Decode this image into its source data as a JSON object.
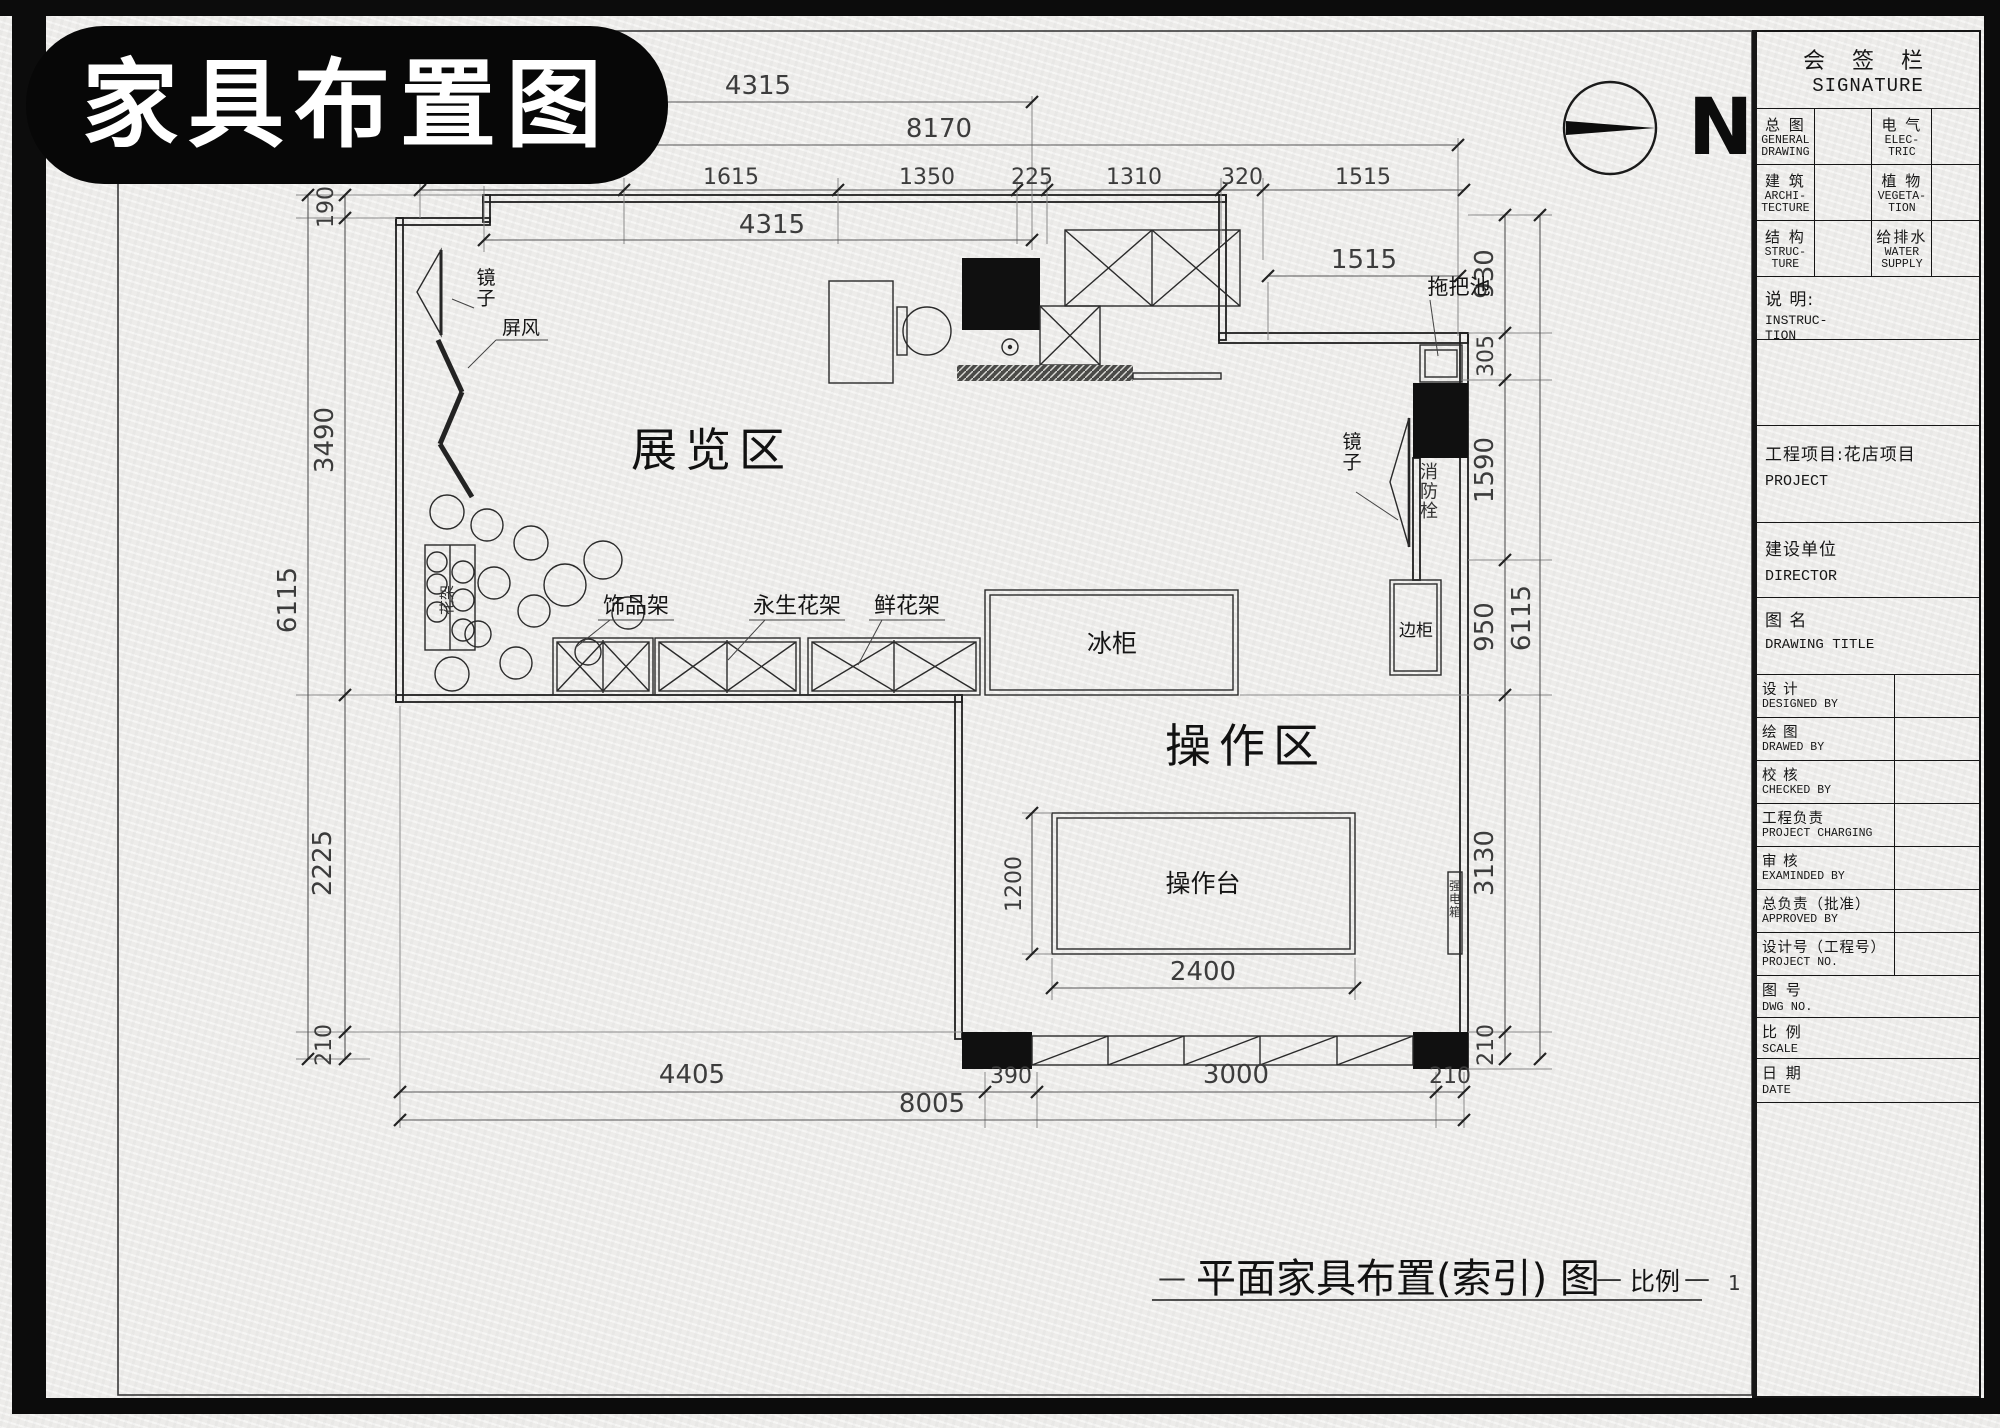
{
  "badge": {
    "title": "家具布置图"
  },
  "compass": {
    "label": "N"
  },
  "signature": {
    "title_cn": "会 签 栏",
    "title_en": "SIGNATURE",
    "cells": [
      {
        "cn": "总 图",
        "en": "GENERAL\nDRAWING"
      },
      {
        "cn": "电 气",
        "en": "ELEC-\nTRIC"
      },
      {
        "cn": "建 筑",
        "en": "ARCHI-\nTECTURE"
      },
      {
        "cn": "植 物",
        "en": "VEGETA-\nTION"
      },
      {
        "cn": "结 构",
        "en": "STRUC-\nTURE"
      },
      {
        "cn": "给排水",
        "en": "WATER\nSUPPLY"
      }
    ]
  },
  "titleblock": {
    "instruction": {
      "cn": "说  明:",
      "en": "INSTRUC-\n TION"
    },
    "project": {
      "cn": "工程项目:花店项目",
      "en": "PROJECT"
    },
    "director": {
      "cn": "建设单位",
      "en": "DIRECTOR"
    },
    "drawing_title": {
      "cn": "图  名",
      "en": "DRAWING TITLE"
    },
    "rows": [
      {
        "cn": "设  计",
        "en": "DESIGNED  BY"
      },
      {
        "cn": "绘  图",
        "en": "DRAWED  BY"
      },
      {
        "cn": "校  核",
        "en": "CHECKED  BY"
      },
      {
        "cn": "工程负责",
        "en": "PROJECT CHARGING"
      },
      {
        "cn": "审  核",
        "en": "EXAMINDED  BY"
      },
      {
        "cn": "总负责（批准）",
        "en": "APPROVED  BY"
      },
      {
        "cn": "设计号（工程号）",
        "en": "PROJECT NO."
      }
    ],
    "bottom_rows": [
      {
        "cn": "图  号",
        "en": "DWG NO."
      },
      {
        "cn": "比  例",
        "en": "SCALE"
      },
      {
        "cn": "日  期",
        "en": "DATE"
      }
    ]
  },
  "plan_labels": {
    "exhibition": "展览区",
    "operation": "操作区",
    "mirror_left": "镜子",
    "screen": "屏风",
    "flower_stand": "花架",
    "rack_accessory": "饰品架",
    "rack_preserved": "永生花架",
    "rack_fresh": "鲜花架",
    "freezer": "冰柜",
    "worktable": "操作台",
    "side_cabinet": "边柜",
    "mop_sink": "拖把池",
    "mirror_right": "镜子",
    "fire_hydrant": "消防栓",
    "power_box": "强电箱"
  },
  "dims": {
    "top1": "4315",
    "top2": "8170",
    "chain": [
      "1615",
      "1350",
      "225",
      "1310",
      "320",
      "1515"
    ],
    "top4": "4315",
    "wing": "1515",
    "left": [
      "190",
      "3490",
      "2225",
      "210"
    ],
    "left_total": "6115",
    "right": [
      "930",
      "305",
      "1590",
      "950"
    ],
    "right_total": "6115",
    "right_lower": "3130",
    "right_bottom": "210",
    "bottom": [
      "4405",
      "390",
      "3000",
      "210"
    ],
    "bottom_total": "8005",
    "table_width": "2400",
    "table_depth": "1200"
  },
  "footer": {
    "dash": "—",
    "title": "平面家具布置(索引) 图",
    "scale_label": "比例",
    "scale_value": "1"
  }
}
